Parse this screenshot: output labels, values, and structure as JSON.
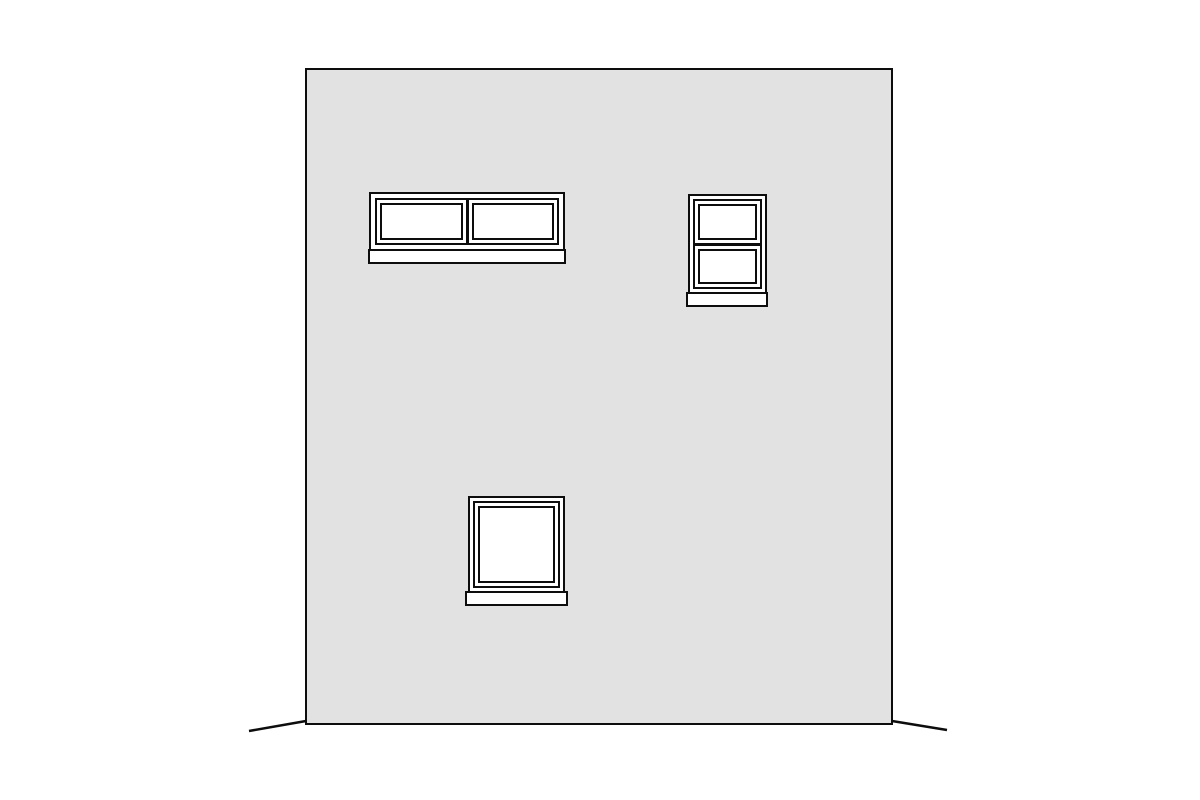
{
  "drawing": {
    "kind": "building-elevation",
    "text_labels": [],
    "colors": {
      "background": "#ffffff",
      "wall_fill": "#e2e2e2",
      "line": "#0d0d0d",
      "glass": "#ffffff"
    },
    "wall": {
      "shape": "rectangle"
    },
    "windows": [
      {
        "id": "horizontal-slider",
        "position": "top-left",
        "panes": 2,
        "divider": "vertical-mullion",
        "has_sill": true
      },
      {
        "id": "double-hung",
        "position": "top-right",
        "panes": 2,
        "divider": "horizontal-meeting-rail",
        "has_sill": true
      },
      {
        "id": "fixed-square",
        "position": "bottom-center",
        "panes": 1,
        "divider": "none",
        "has_sill": true
      }
    ],
    "ground": {
      "segments": 2
    }
  }
}
